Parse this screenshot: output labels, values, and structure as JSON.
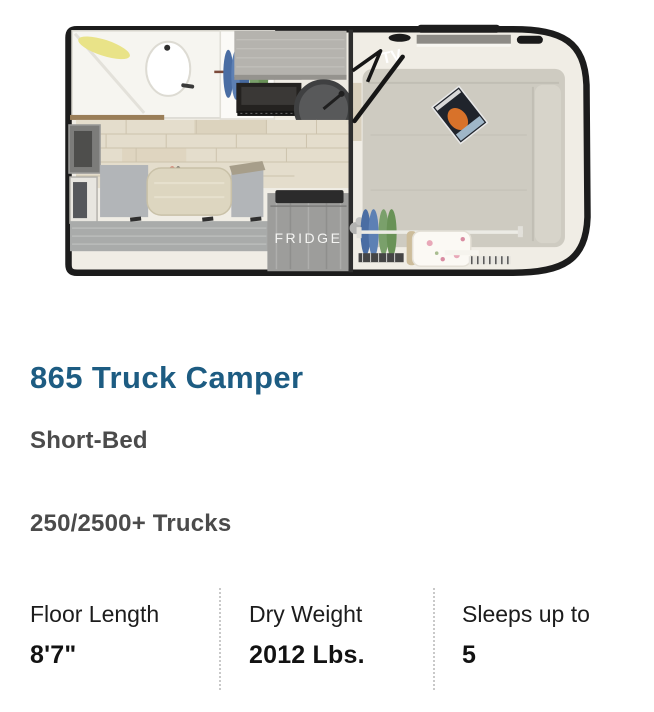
{
  "details": {
    "title": "865 Truck Camper",
    "bed_type": "Short-Bed",
    "truck_type": "250/2500+ Trucks"
  },
  "specs": [
    {
      "label": "Floor Length",
      "value": "8'7\""
    },
    {
      "label": "Dry Weight",
      "value": "2012 Lbs."
    },
    {
      "label": "Sleeps up to",
      "value": "5"
    }
  ],
  "floorplan": {
    "tv_label": "TV",
    "fridge_label": "FRIDGE"
  },
  "colors": {
    "title_blue": "#1d5c82",
    "heading_gray": "#4b4b4b",
    "spec_text": "#1c1c1c",
    "spec_divider_dotted": "#c9c9c9",
    "shell_border_black": "#1c1c1c",
    "floor_ivory": "#f0ede5",
    "mattress_beige": "#cecbc1",
    "cabinet_gray": "#b5b3ae",
    "bench_gray": "#a9abaa",
    "table_beige": "#ddd6c0",
    "fridge_gray": "#9d9d9b",
    "tile_beige": "#e4ddcc",
    "clothes_blue": "#5d80b4",
    "clothes_green": "#7aa06b",
    "towel_yellow": "#e9e388",
    "magazine_orange": "#d8722a"
  }
}
